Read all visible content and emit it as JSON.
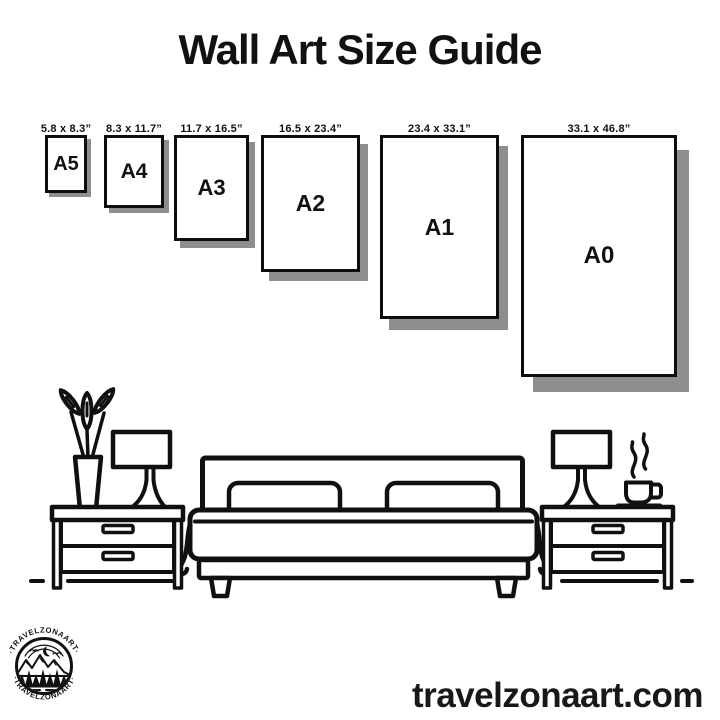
{
  "title": "Wall Art Size Guide",
  "sizes": [
    {
      "code": "A5",
      "dimensions": "5.8 x 8.3”"
    },
    {
      "code": "A4",
      "dimensions": "8.3 x 11.7”"
    },
    {
      "code": "A3",
      "dimensions": "11.7 x 16.5”"
    },
    {
      "code": "A2",
      "dimensions": "16.5 x 23.4”"
    },
    {
      "code": "A1",
      "dimensions": "23.4 x 33.1”"
    },
    {
      "code": "A0",
      "dimensions": "33.1 x 46.8”"
    }
  ],
  "footer": {
    "website": "travelzonaart.com"
  },
  "logo": {
    "brand_arc_text": "·TRAVELZONAART·"
  },
  "colors": {
    "ink": "#101010",
    "shadow": "#8e8e8e",
    "background": "#ffffff"
  },
  "illustration": {
    "scene": "bedroom with double bed, two pillows, two nightstands, two lamps, vase with plant, steaming coffee cup"
  }
}
